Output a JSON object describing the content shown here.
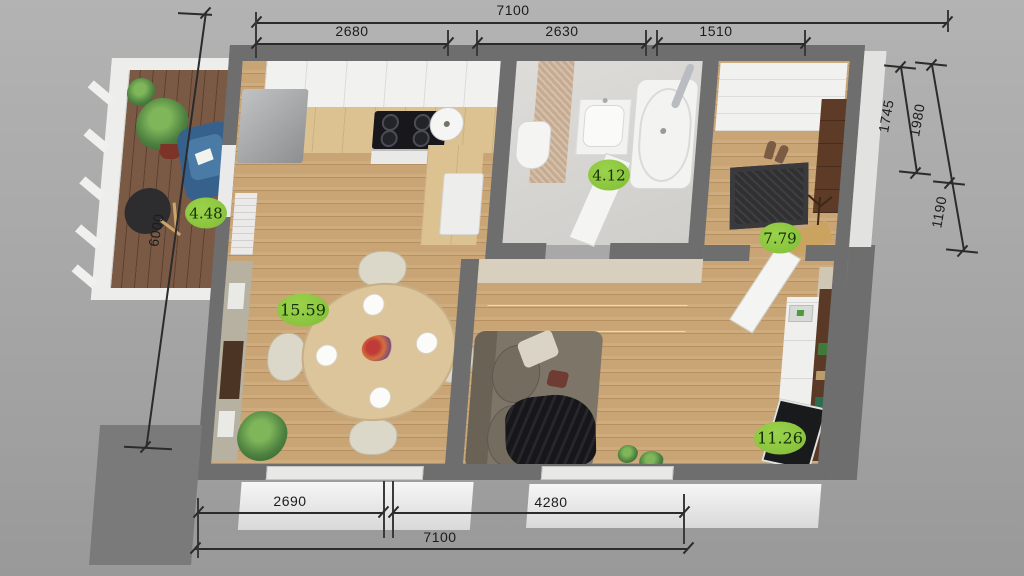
{
  "dims": {
    "top_overall": "7100",
    "top_seg1": "2680",
    "top_seg2": "2630",
    "top_seg3": "1510",
    "right_seg1": "1745",
    "right_seg2": "1980",
    "right_seg3": "1190",
    "left_seg1": "6000",
    "bottom_seg1": "2690",
    "bottom_seg2": "4280",
    "bottom_overall": "7100"
  },
  "areas": {
    "balcony": "4.48",
    "bathroom": "4.12",
    "hallway": "7.79",
    "living_room": "15.59",
    "bedroom": "11.26"
  },
  "colors": {
    "background": "#a7a7a7",
    "wall": "#6e6e6e",
    "wood_floor": "#c9a474",
    "balcony_floor": "#7b5a45",
    "area_badge": "#8cc63e",
    "dimension_line": "#2b2b2b"
  }
}
